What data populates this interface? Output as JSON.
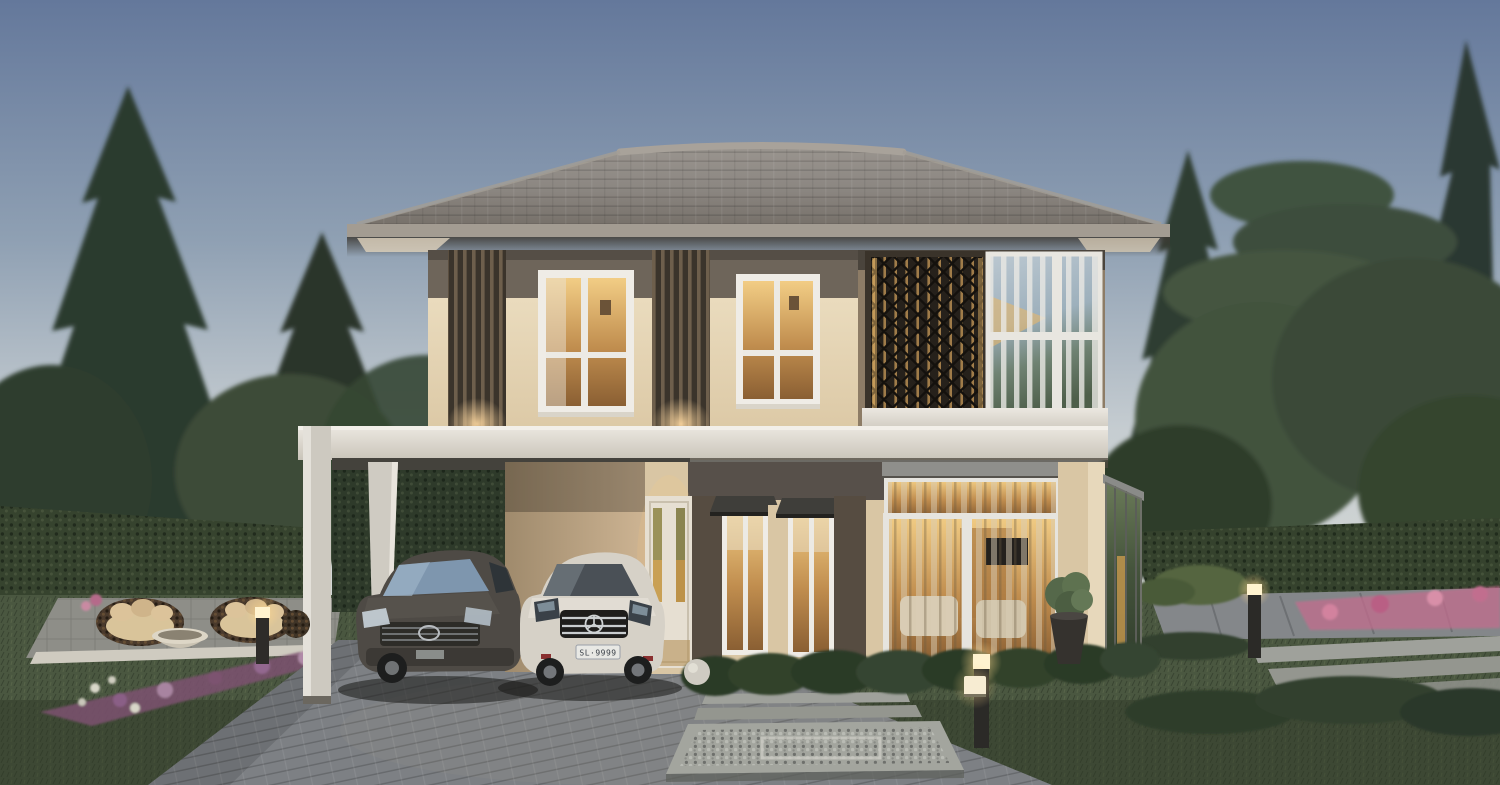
{
  "scene": {
    "type": "photorealistic-exterior-render",
    "time_of_day": "dusk",
    "description": "Two-storey modern detached house at dusk with hip tile roof, warm lit windows, decorative lattice screen, carport with two parked cars, hedge fence, pine trees and landscaped garden"
  },
  "palette": {
    "sky_top": "#64789b",
    "sky_mid": "#8fa0b3",
    "sky_horizon": "#c6cdd1",
    "tree_dark": "#2c3a2f",
    "tree_mid": "#3c4c38",
    "hedge_green": "#36432e",
    "lawn_green": "#4a5740",
    "roof_grey": "#8e8a85",
    "fascia_grey": "#a39c92",
    "wall_cream": "#e7d8bb",
    "wall_band_dark": "#6e655a",
    "wall_bronze": "#8d7c66",
    "beam_white": "#dfdbd3",
    "slat_bronze": "#6e5f4c",
    "warm_light": "#f2cd85",
    "warm_deep": "#8a5f33",
    "driveway_grey": "#7d8084",
    "paver_light": "#9fa19b",
    "car_dark_body": "#4e4a45",
    "car_white_body": "#d6d1c7",
    "flower_purple": "#7c5270",
    "flower_pink": "#c16e8e",
    "glass_reflection": "#a7b8c4"
  },
  "cars": {
    "dark_sedan": {
      "brand_mark": "toyota-emblem",
      "body_color_name": "graphite"
    },
    "white_sedan": {
      "brand_mark": "mercedes-star",
      "license_plate": "SL·9999"
    }
  },
  "lighting": {
    "interior_windows": "warm amber",
    "exterior_fixtures": "bollard lights, ground cube light, slat-column uplights"
  }
}
